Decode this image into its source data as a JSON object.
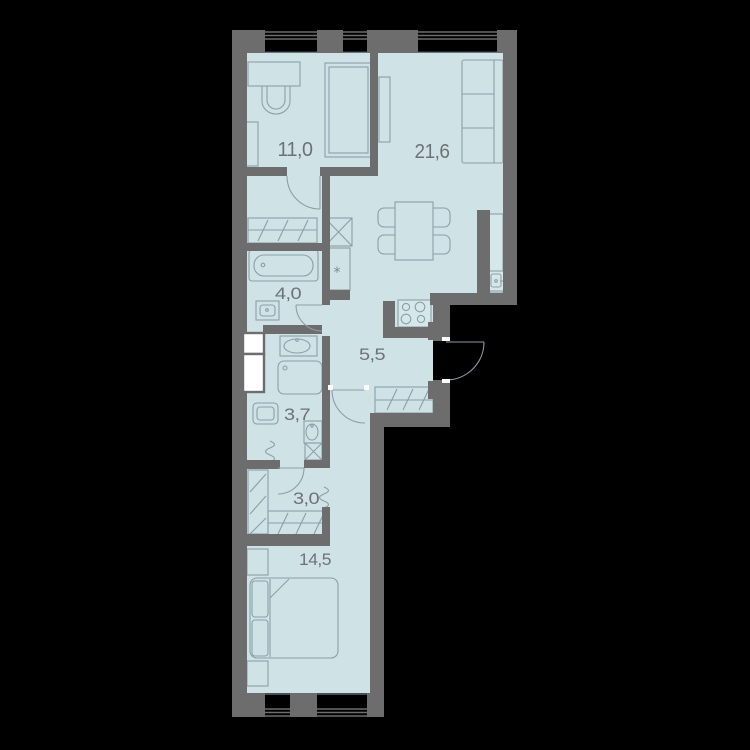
{
  "plan": {
    "title": "apartment-floor-plan",
    "colors": {
      "background": "#000000",
      "wall": "#6d6d6d",
      "room_fill": "#cfe2e6",
      "furniture_line": "#8aa0a8",
      "label": "#6e7276",
      "shaft_fill": "#ffffff"
    },
    "rooms": [
      {
        "name": "bedroom-2",
        "area_label": "11,0"
      },
      {
        "name": "living-kitchen",
        "area_label": "21,6"
      },
      {
        "name": "bathroom",
        "area_label": "4,0"
      },
      {
        "name": "hallway",
        "area_label": "5,5"
      },
      {
        "name": "shower-room",
        "area_label": "3,7"
      },
      {
        "name": "wardrobe-hall",
        "area_label": "3,0"
      },
      {
        "name": "bedroom-1",
        "area_label": "14,5"
      }
    ],
    "symbols": {
      "tall_cabinet": "*"
    },
    "fixtures": [
      "desk",
      "desk-chair",
      "single-bed",
      "sofa",
      "tv-board",
      "dining-table",
      "four-chairs",
      "kitchen-counter",
      "kitchen-sink",
      "stove",
      "bathtub",
      "washbasin",
      "shower-tray",
      "washing-machine",
      "vent-shaft",
      "wardrobe",
      "double-bed",
      "nightstands",
      "towel-radiator"
    ],
    "windows_top": 3,
    "windows_bottom": 2,
    "entrance_doors": 1
  }
}
